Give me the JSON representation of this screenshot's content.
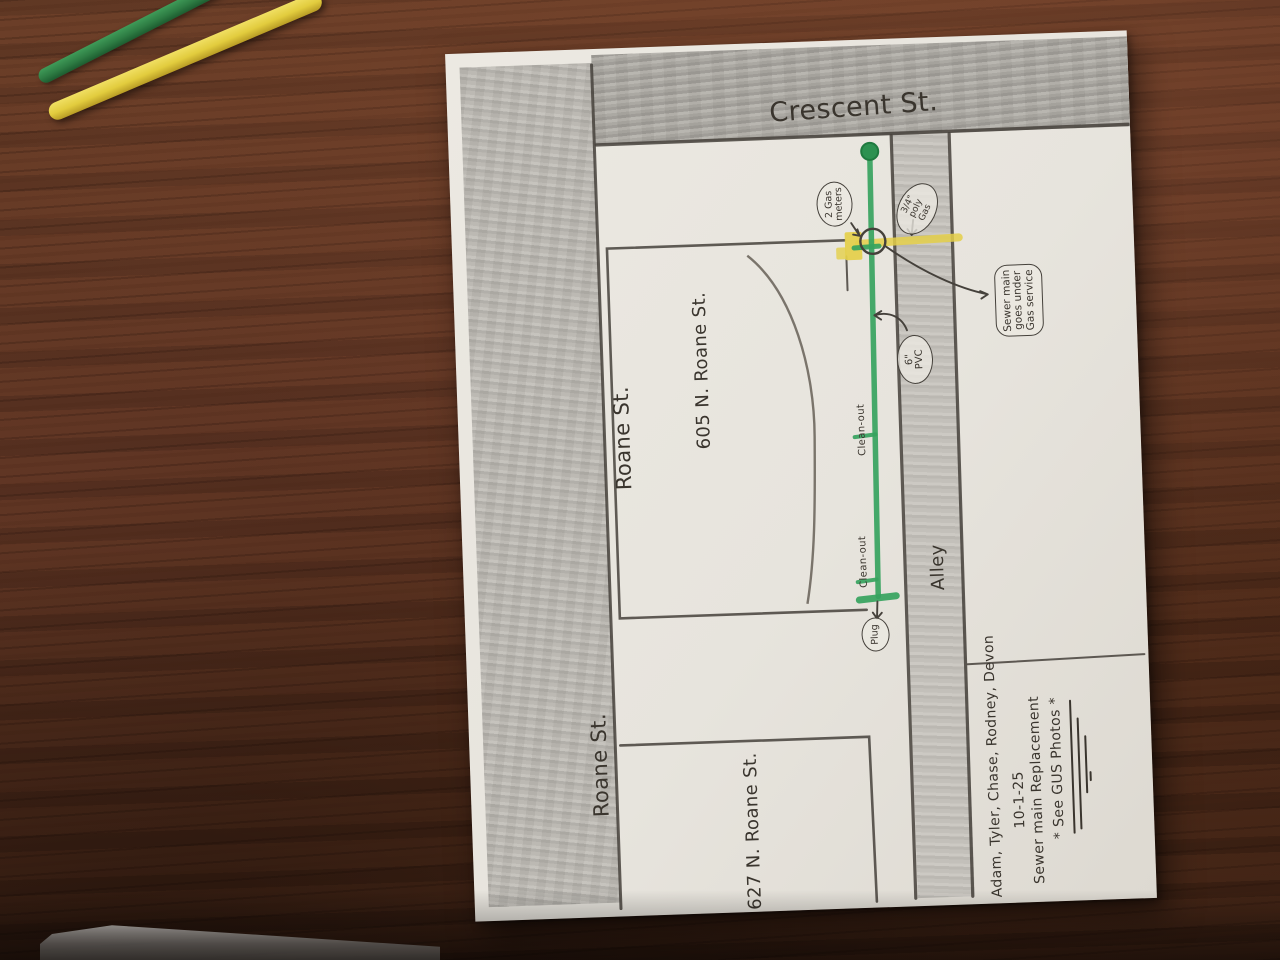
{
  "map": {
    "streets": {
      "crescent": "Crescent St.",
      "roane_upper": "Roane St.",
      "roane_lower": "Roane St.",
      "alley": "Alley"
    },
    "addresses": {
      "house_605": "605 N. Roane St.",
      "house_627": "627 N. Roane St."
    },
    "callouts": {
      "gas_meters": {
        "line1": "2 Gas",
        "line2": "meters"
      },
      "gas_size": {
        "line1": "3/4\"",
        "line2": "poly",
        "line3": "Gas"
      },
      "crossing": {
        "line1": "Sewer main",
        "line2": "goes under",
        "line3": "Gas service"
      },
      "sewer_size": {
        "line1": "6\"",
        "line2": "PVC"
      },
      "plug": "Plug",
      "cleanout_upper": "Clean-out",
      "cleanout_lower": "Clean-out"
    },
    "notes": {
      "crew": "Adam, Tyler, Chase, Rodney, Devon",
      "date": "10-1-25",
      "job": "Sewer main Replacement",
      "photos": "* See GUS Photos *"
    },
    "legend_colors": {
      "sewer_main_green": "#36a35e",
      "gas_service_yellow": "#e4cf49",
      "pencil_graphite": "#4a463f",
      "paper": "#e9e6df"
    }
  }
}
